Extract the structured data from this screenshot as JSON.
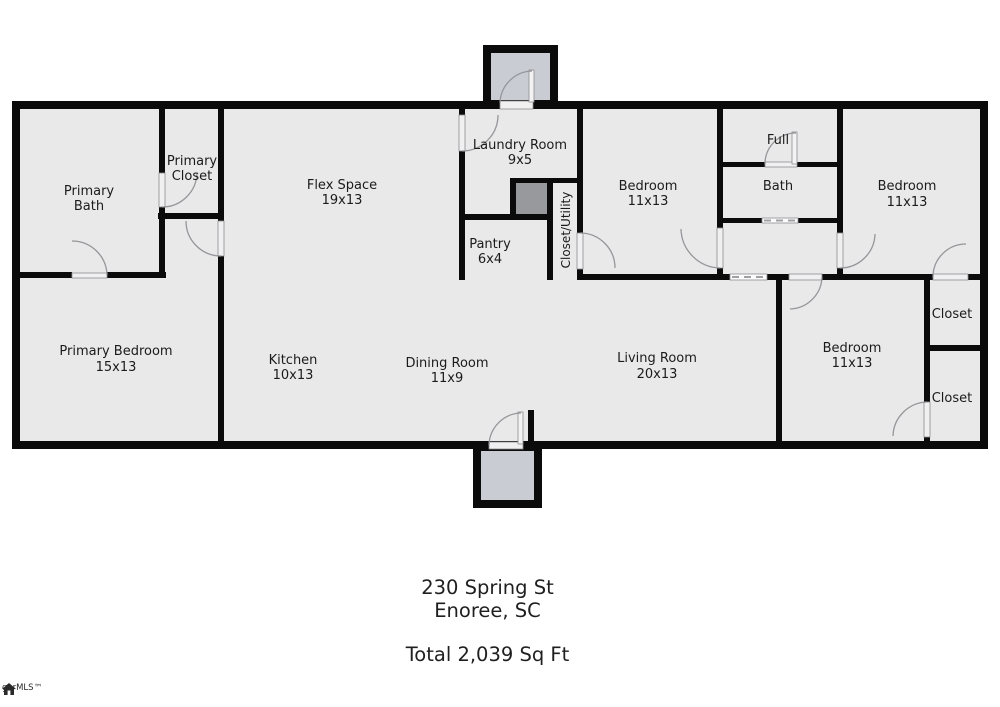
{
  "palette": {
    "floor": "#e9e9ea",
    "wall": "#0b0b0b",
    "porch": "#c9ccd3",
    "shaft": "#97999c",
    "door_arc": "#96969a",
    "text": "#1b1b1b"
  },
  "rooms": {
    "primary_bath": {
      "l1": "Primary",
      "l2": "Bath"
    },
    "primary_closet": {
      "l1": "Primary",
      "l2": "Closet"
    },
    "flex": {
      "l1": "Flex Space",
      "l2": "19x13"
    },
    "laundry": {
      "l1": "Laundry Room",
      "l2": "9x5"
    },
    "bedroom_mid": {
      "l1": "Bedroom",
      "l2": "11x13"
    },
    "full": {
      "l1": "Full"
    },
    "bath": {
      "l1": "Bath"
    },
    "bedroom_tr": {
      "l1": "Bedroom",
      "l2": "11x13"
    },
    "pantry": {
      "l1": "Pantry",
      "l2": "6x4"
    },
    "closet_utility": {
      "l1": "Closet/Utility"
    },
    "primary_bedroom": {
      "l1": "Primary Bedroom",
      "l2": "15x13"
    },
    "kitchen": {
      "l1": "Kitchen",
      "l2": "10x13"
    },
    "dining": {
      "l1": "Dining Room",
      "l2": "11x9"
    },
    "living": {
      "l1": "Living Room",
      "l2": "20x13"
    },
    "bedroom_br": {
      "l1": "Bedroom",
      "l2": "11x13"
    },
    "closet_tr": {
      "l1": "Closet"
    },
    "closet_br": {
      "l1": "Closet"
    }
  },
  "footer": {
    "address_line1": "230 Spring St",
    "address_line2": "Enoree, SC",
    "total": "Total 2,039 Sq Ft"
  },
  "logo": {
    "text": "garMLS™"
  }
}
